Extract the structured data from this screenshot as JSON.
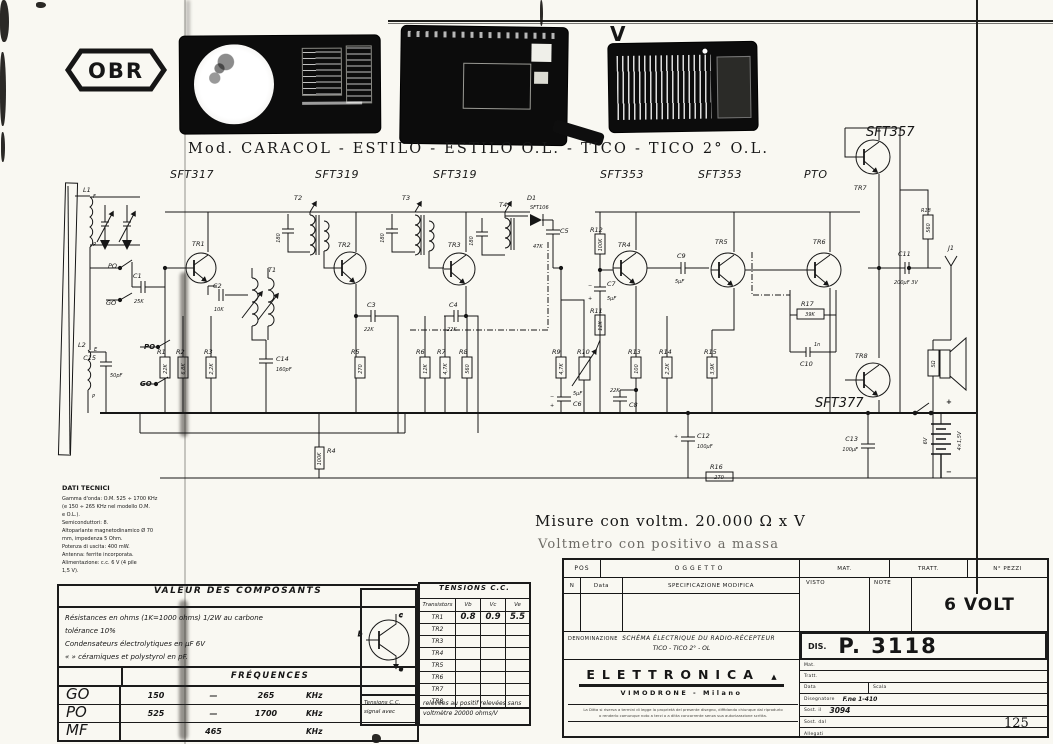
{
  "colors": {
    "paper": "#f9f8f2",
    "ink": "#161616"
  },
  "logo": {
    "text": "OBR"
  },
  "header": {
    "v_mark": "V",
    "title": "Mod. CARACOL - ESTILO - ESTILO O.L. - TICO - TICO 2° O.L.",
    "transistor_row": [
      "SFT317",
      "SFT319",
      "SFT319",
      "SFT353",
      "SFT353",
      "PTO"
    ]
  },
  "notes": {
    "measure_line1": "Misure con voltm. 20.000 Ω x V",
    "measure_line2": "Voltmetro con positivo a massa"
  },
  "dati_tecnici": {
    "title": "DATI TECNICI",
    "lines": [
      "Gamma d'onda: O.M. 525 ÷ 1700 KHz",
      "(e 150 ÷ 265 KHz nel modello O.M.",
      "e O.L.).",
      "Semiconduttori: 8.",
      "Altoparlante magnetodinamico Ø 70",
      "mm, impedenza 5 Ohm.",
      "Potenza di uscita: 400 mW.",
      "Antenna: ferrite incorporata.",
      "Alimentazione: c.c. 6 V (4 pile",
      "1,5 V)."
    ]
  },
  "components_table": {
    "title": "VALEUR  DES  COMPOSANTS",
    "notes": [
      "Résistances  en ohms (1K=1000 ohms)  1/2W  au  carbone",
      "tolérance 10%",
      "Condensateurs  électrolytiques  en  μF   6V",
      "«        »        céramiques  et  polystyrol  en  pF."
    ],
    "freq_title": "FRÉQUENCES",
    "freq_rows": [
      {
        "band": "GO",
        "from": "150",
        "dash": "—",
        "to": "265",
        "unit": "KHz"
      },
      {
        "band": "PO",
        "from": "525",
        "dash": "—",
        "to": "1700",
        "unit": "KHz"
      },
      {
        "band": "MF",
        "from": "",
        "dash": "465",
        "to": "",
        "unit": "KHz"
      }
    ]
  },
  "tensions": {
    "title": "TENSIONS C.C.",
    "headers": [
      "Transistors",
      "Vb",
      "Vc",
      "Ve"
    ],
    "rows": [
      {
        "name": "TR1",
        "vb": "0.8",
        "vc": "0.9",
        "ve": "5.5"
      },
      {
        "name": "TR2",
        "vb": "",
        "vc": "",
        "ve": ""
      },
      {
        "name": "TR3",
        "vb": "",
        "vc": "",
        "ve": ""
      },
      {
        "name": "TR4",
        "vb": "",
        "vc": "",
        "ve": ""
      },
      {
        "name": "TR5",
        "vb": "",
        "vc": "",
        "ve": ""
      },
      {
        "name": "TR6",
        "vb": "",
        "vc": "",
        "ve": ""
      },
      {
        "name": "TR7",
        "vb": "",
        "vc": "",
        "ve": ""
      },
      {
        "name": "TR8",
        "vb": "",
        "vc": "",
        "ve": ""
      }
    ],
    "footer_left": [
      "Tensions C.C.",
      "signal avec"
    ],
    "footer_right": [
      "relevées au positif relevées sans",
      "voltmètre 20000 ohms/V"
    ],
    "pinout": {
      "c": "c",
      "b": "b",
      "e": "e"
    }
  },
  "title_block": {
    "pos": "POS",
    "oggetto": "OGGETTO",
    "n": "N",
    "data_col": "Data",
    "specificazione": "SPECIFICAZIONE MODIFICA",
    "mat": "MAT.",
    "tratt": "TRATT.",
    "n_pezzi": "N° PEZZI",
    "visto": "VISTO",
    "note": "NOTE",
    "voltage": "6 VOLT",
    "denominazione_label": "DENOMINAZIONE",
    "denominazione_line1": "SCHÉMA ÉLECTRIQUE DU RADIO-RÉCEPTEUR",
    "denominazione_line2": "TICO - TICO 2° - OL",
    "dis_label": "DIS.",
    "dis_number": "P. 3118",
    "company": "ELETTRONICA",
    "company_mark": "▲",
    "city": "VIMODRONE - Milano",
    "footnote": [
      "La Ditta si riserva a termini di legge la proprietà del presente disegno, diffidando chiunque dal riprodurlo",
      "o renderlo comunque noto a terzi o a ditta concorrente senza sua autorizzazione scritta."
    ],
    "side_rows": [
      {
        "label": "Mat.",
        "value": ""
      },
      {
        "label": "Tratt.",
        "value": ""
      },
      {
        "label": "Data",
        "value": "",
        "label2": "Scala",
        "value2": ""
      },
      {
        "label": "Disegnatore",
        "value": "F.ne  1-410"
      },
      {
        "label": "Sost. il",
        "value": "3094"
      },
      {
        "label": "Sost. dal",
        "value": ""
      },
      {
        "label": "Allegati",
        "value": ""
      }
    ]
  },
  "page_number": "125",
  "schematic": {
    "l1": "L1",
    "l1_f": "F",
    "l1_p": "P",
    "l2": "L2",
    "l2_e": "E",
    "l2_p": "P",
    "po_a": "PO",
    "go_a": "GO",
    "po_b": "PO",
    "go_b": "GO",
    "c15": "C15",
    "c15_v": "50pF",
    "c1": "C1",
    "c1_v": "25K",
    "c2": "C2",
    "c2_v": "10K",
    "tr1": "TR1",
    "tr2": "TR2",
    "tr3": "TR3",
    "tr4": "TR4",
    "tr5": "TR5",
    "tr6": "TR6",
    "tr7": "TR7",
    "tr8": "TR8",
    "r1": "R1",
    "r1_v": "22K",
    "r2": "R2",
    "r2_v": "6,8K",
    "r3": "R3",
    "r3_v": "2,2K",
    "r4": "R4",
    "r4_v": "100K",
    "t1": "T1",
    "c14": "C14",
    "c14_v": "160pF",
    "t2": "T2",
    "t2_c": "180",
    "t3": "T3",
    "t3_c": "180",
    "t4": "T4",
    "t4_c": "180",
    "c3": "C3",
    "c3_v": "22K",
    "r5": "R5",
    "r5_v": "270",
    "c4": "C4",
    "c4_v": "22K",
    "r6": "R6",
    "r6_v": "12K",
    "r7": "R7",
    "r7_v": "4,7K",
    "r8": "R8",
    "r8_v": "560",
    "d1": "D1",
    "d1_type": "SFT106",
    "c5": "C5",
    "c5_v": "47K",
    "r9": "R9",
    "r9_v": "4,7K",
    "r10": "R10",
    "c6": "C6",
    "c6_v": "5μF",
    "r12": "R12",
    "r12_v": "100K",
    "c7": "C7",
    "c7_v": "5μF",
    "r11": "R11",
    "r11_v": "12K",
    "r13": "R13",
    "r13_v": "100",
    "r14": "R14",
    "r14_v": "2,2K",
    "r15": "R15",
    "r15_v": "3,9K",
    "c8": "C8",
    "c8_v": "22K",
    "c9": "C9",
    "c9_v": "5μF",
    "r17": "R17",
    "r17_v": "39K",
    "c10": "C10",
    "c10_v": "1n",
    "sft357": "SFT357",
    "r18": "R18",
    "r18_v": "560",
    "sft377": "SFT377",
    "c11": "C11",
    "c11_v": "200μF 3V",
    "j1": "J1",
    "spk_v": "5Ω",
    "c13": "C13",
    "c13_v": "100μF",
    "c12": "C12",
    "c12_v": "100μF",
    "r16": "R16",
    "r16_v": "270",
    "bat_v": "6V",
    "bat_cells": "4×1,5V",
    "plus": "+",
    "minus": "−"
  }
}
